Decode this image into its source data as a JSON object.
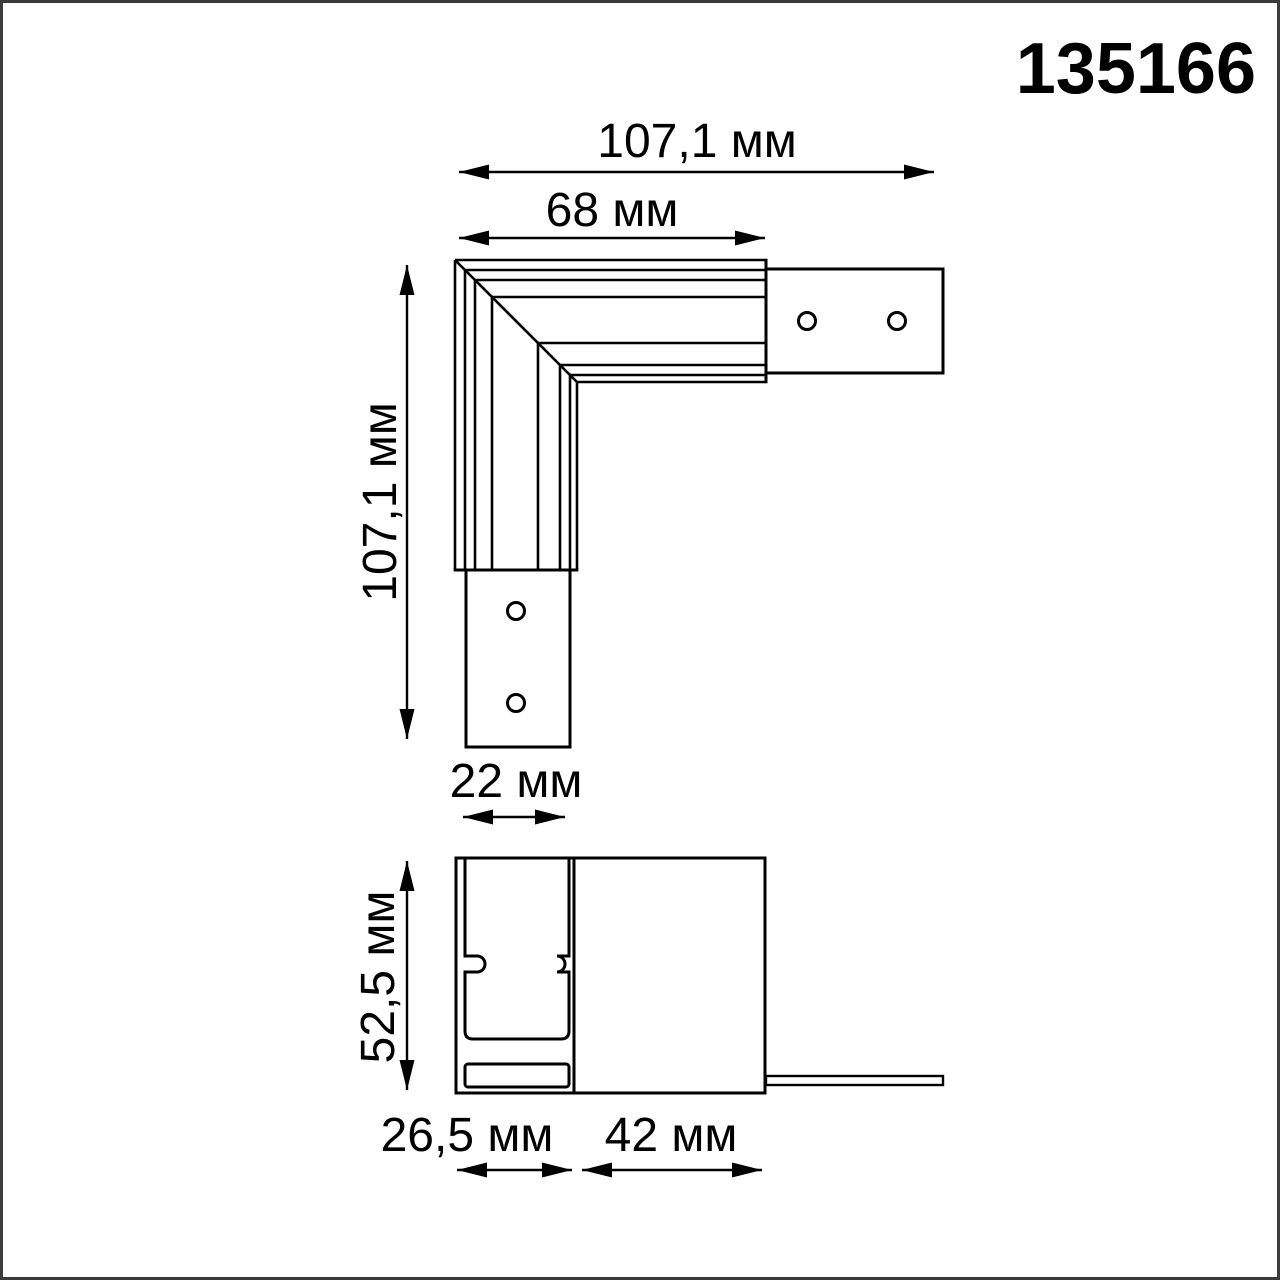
{
  "part_number": "135166",
  "top_view": {
    "dim_overall_width": "107,1 мм",
    "dim_track_width": "68 мм",
    "dim_overall_height": "107,1 мм",
    "dim_plate_width": "22 мм"
  },
  "section_view": {
    "dim_height": "52,5 мм",
    "dim_width_left": "26,5 мм",
    "dim_width_right": "42 мм"
  },
  "colors": {
    "line": "#000000",
    "frame": "#3c3c3c",
    "background": "#ffffff"
  }
}
